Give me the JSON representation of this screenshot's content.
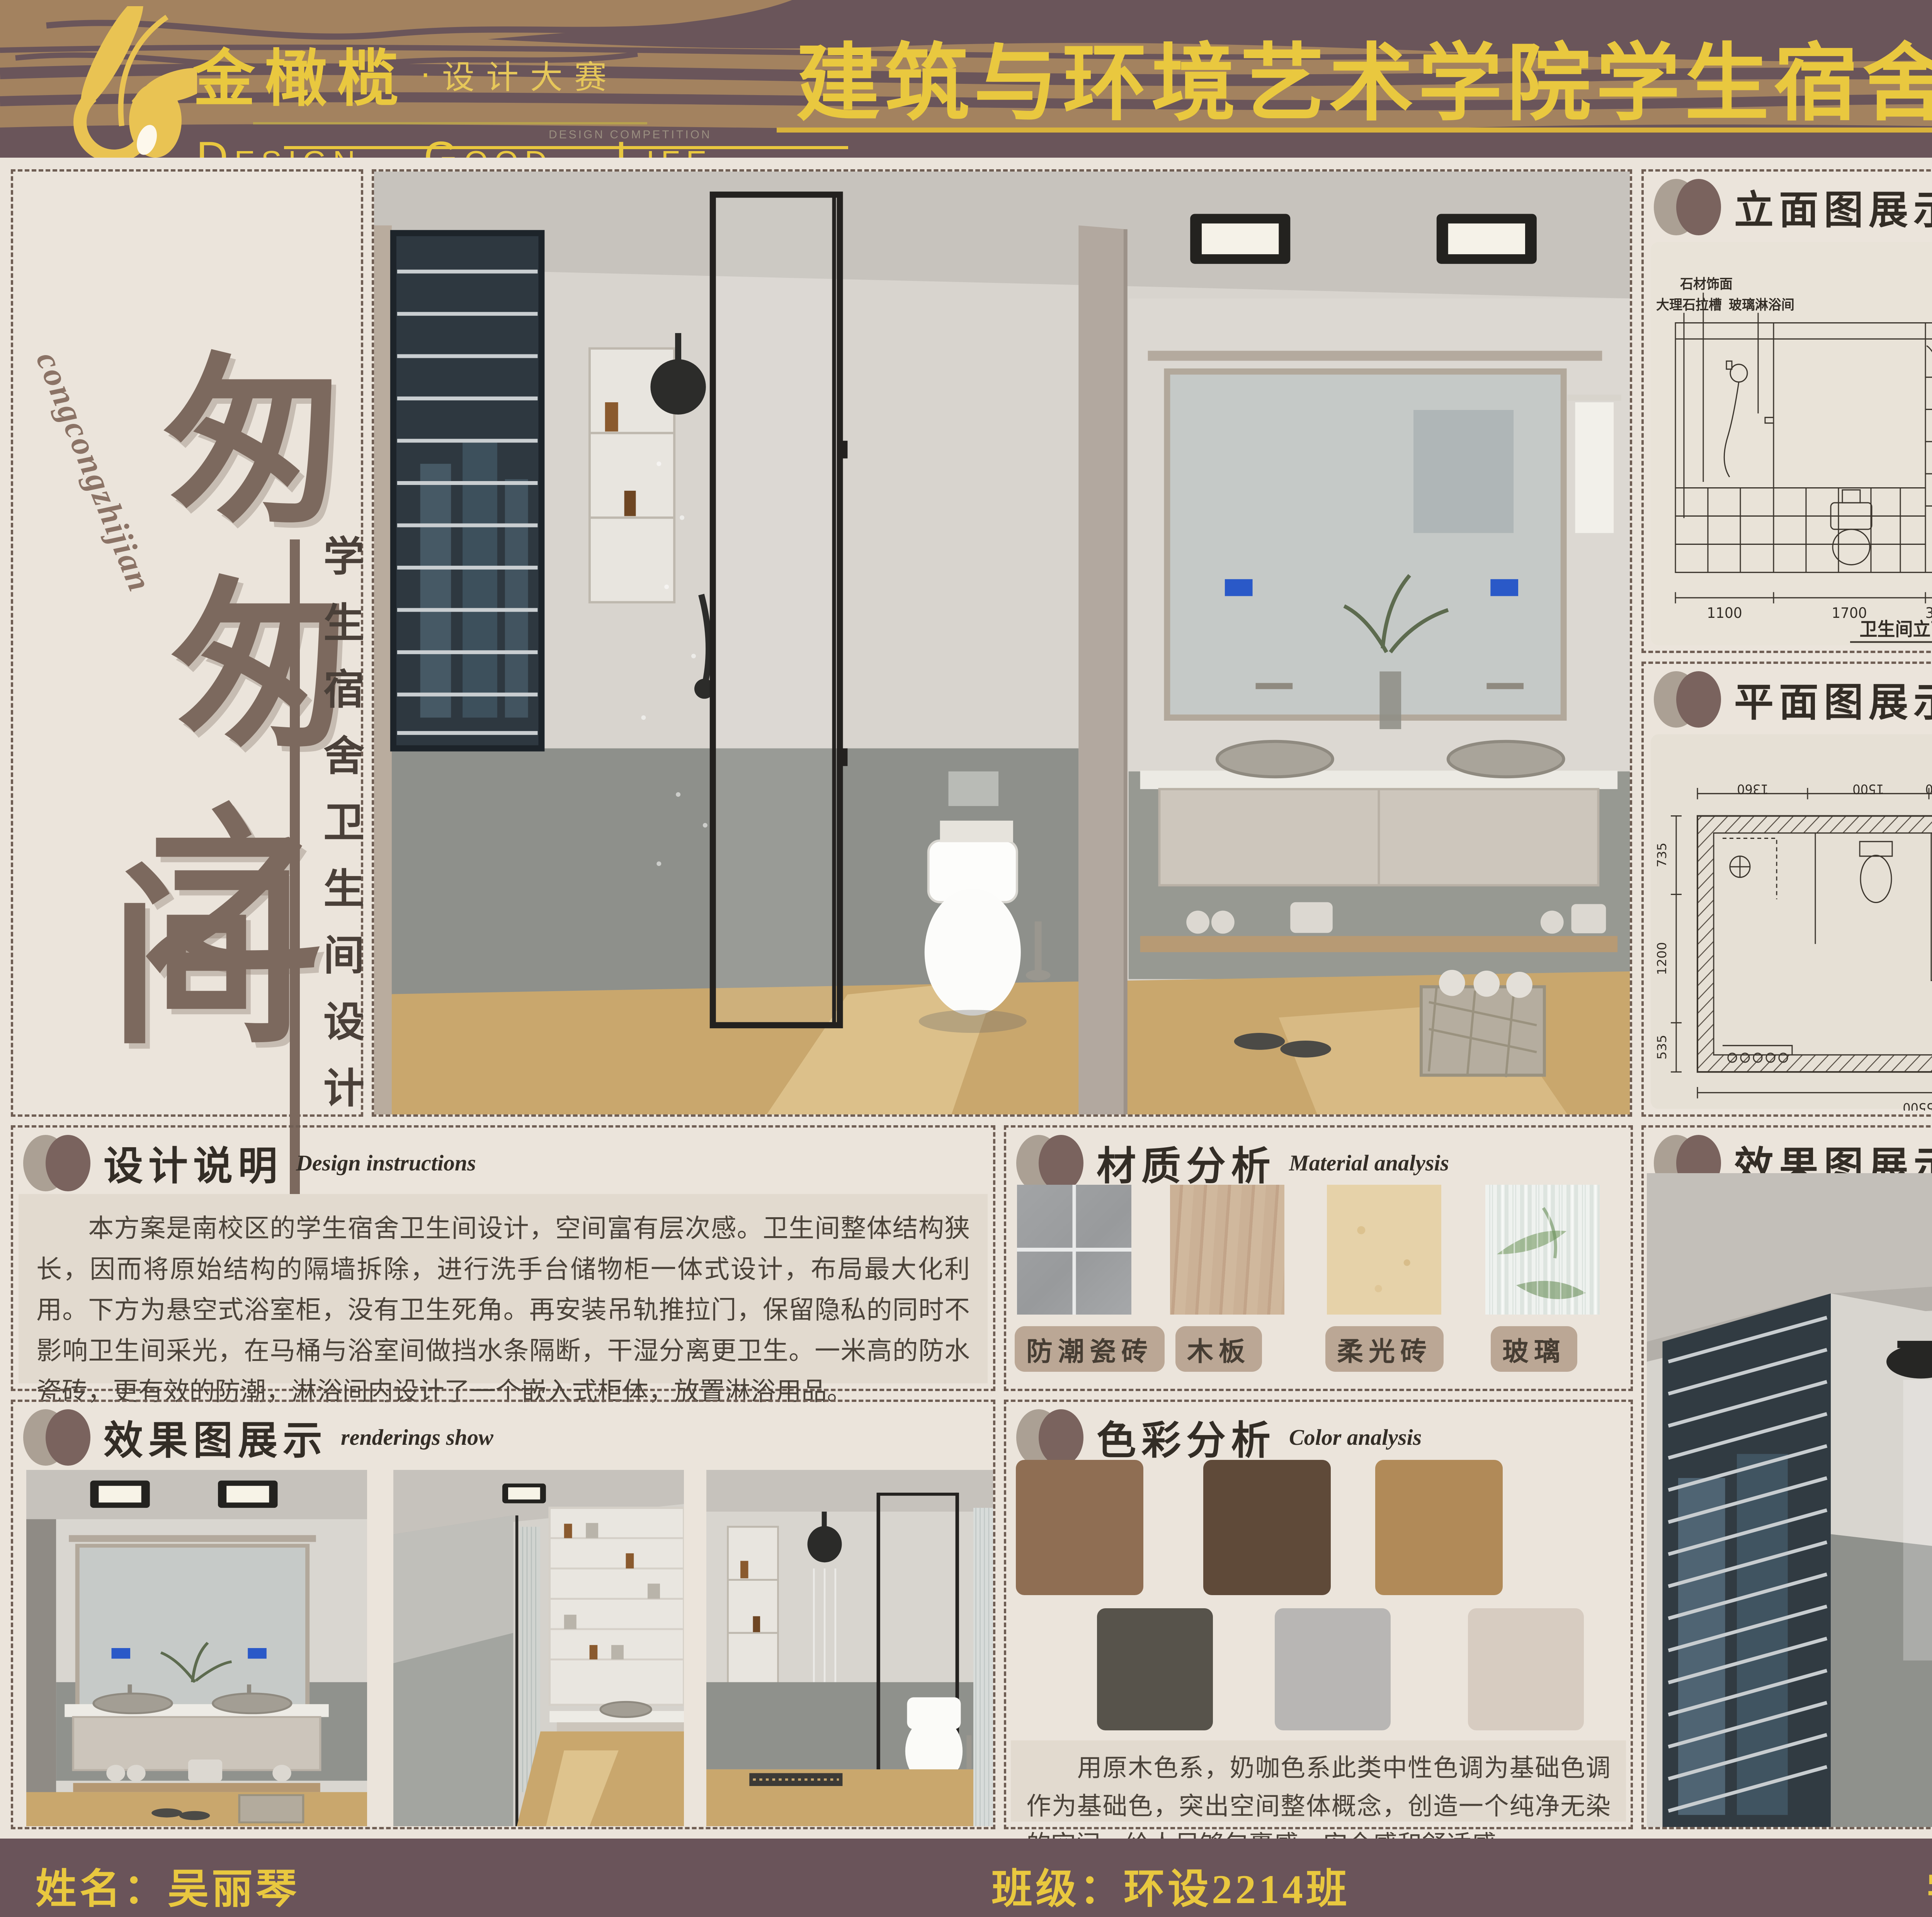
{
  "banner": {
    "logo_cn": "金橄榄",
    "logo_dot": "·",
    "logo_sub_cn": "设计大赛",
    "logo_sub_en": "DESIGN COMPETITION",
    "slogan": "Design.  Good.  Life",
    "title": "建筑与环境艺术学院学生宿舍卫生间设计大赛"
  },
  "left_panel": {
    "romanization": "congcongzhijian",
    "title_chars": [
      "匆",
      "匆",
      "之",
      "间"
    ],
    "subtitle_vertical": "学生宿舍卫生间设计"
  },
  "sections": {
    "elevation": {
      "cn": "立面图展示",
      "en": "Elevation display"
    },
    "floorplan": {
      "cn": "平面图展示",
      "en": "Floor plan display"
    },
    "design": {
      "cn": "设计说明",
      "en": "Design instructions"
    },
    "material": {
      "cn": "材质分析",
      "en": "Material analysis"
    },
    "color": {
      "cn": "色彩分析",
      "en": "Color analysis"
    },
    "render": {
      "cn": "效果图展示",
      "en": "renderings show"
    }
  },
  "elevation_b": {
    "callouts": [
      "石材饰面",
      "大理石拉槽",
      "玻璃淋浴间",
      "铝扣板吊顶",
      "木饰面立柜",
      "防水瓷砖",
      "大理石洗手台",
      "定制浴室柜"
    ],
    "dims_bottom": [
      "1100",
      "1700",
      "300",
      "2400"
    ],
    "dims_right": [
      "200",
      "700",
      "1030",
      "310",
      "535",
      "360"
    ],
    "caption": "卫生间立面图B"
  },
  "floor_plan": {
    "dims_top": [
      "1360",
      "1500",
      "200",
      "2400",
      "240"
    ],
    "dims_left": [
      "735",
      "1200",
      "535"
    ],
    "dims_right": [
      "1320",
      "850",
      "350"
    ],
    "dims_bottom": [
      "5500",
      "240"
    ],
    "side_label": "卫生间平面布置图"
  },
  "elevation_c": {
    "level_top": "CH SLAN",
    "level_bottom": "FFL ±0.000",
    "dim_left": "2800",
    "dims_right": [
      "600",
      "2200"
    ],
    "dims_bottom": [
      "429",
      "545",
      "780",
      "191"
    ],
    "dim_total": "1946",
    "caption": "卫生间立面C(1:30)"
  },
  "elevation_a": {
    "level_top": "CH SLAN",
    "level_bottom": "FFL ±0.000",
    "dim_left": "2800",
    "dim_right": "2800",
    "dims_bottom": [
      "173",
      "1291",
      "482"
    ],
    "dim_total": "1946",
    "caption": "卫生间立面A(1:45)"
  },
  "design_text": "　　本方案是南校区的学生宿舍卫生间设计，空间富有层次感。卫生间整体结构狭长，因而将原始结构的隔墙拆除，进行洗手台储物柜一体式设计，布局最大化利用。下方为悬空式浴室柜，没有卫生死角。再安装吊轨推拉门，保留隐私的同时不影响卫生间采光，在马桶与浴室间做挡水条隔断，干湿分离更卫生。一米高的防水瓷砖，更有效的防潮，淋浴间内设计了一个嵌入式柜体，放置淋浴用品。",
  "materials": [
    {
      "label": "防潮瓷砖"
    },
    {
      "label": "木板"
    },
    {
      "label": "柔光砖"
    },
    {
      "label": "玻璃"
    }
  ],
  "color_analysis": {
    "row1": [
      "#8f6e53",
      "#5f4a39",
      "#b18a58"
    ],
    "row2": [
      "#57534b",
      "#b8b6b4",
      "#d7ccc1"
    ],
    "text": "　　用原木色系，奶咖色系此类中性色调为基础色调作为基础色，突出空间整体概念，创造一个纯净无染的空间，给人足够包裹感，安全感和舒适感。"
  },
  "footer": {
    "name": "姓名：吴丽琴",
    "class": "班级：环设2214班",
    "id": "学号：202140857"
  }
}
